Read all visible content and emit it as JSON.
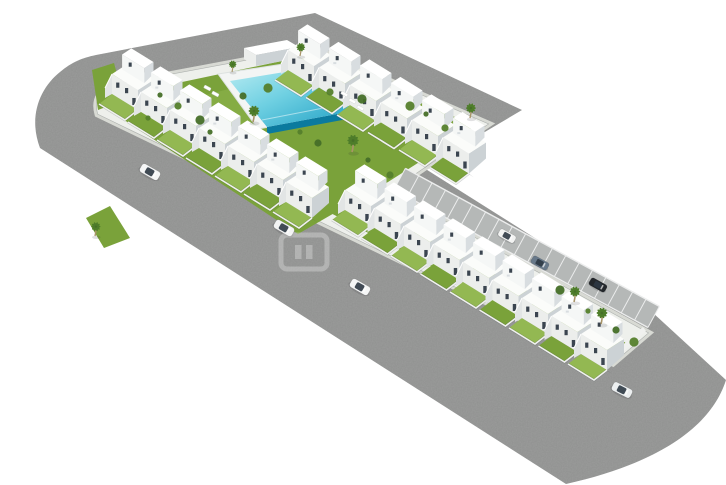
{
  "meta": {
    "description": "Aerial isometric 3D render of a white residential housing development with communal pool, perimeter roads, parking strip and cars",
    "visible_text": "none"
  },
  "scene": {
    "canvas": {
      "w": 726,
      "h": 485,
      "background": "#ffffff"
    },
    "colors": {
      "road": "#9c9d9c",
      "road_noise": "#5f605f",
      "sidewalk": "#d8dad4",
      "curb_line": "rgba(95,100,104,0.35)",
      "platform": "#eef0ec",
      "grass": "#7aa23a",
      "grass_light": "#93b852",
      "bush": "#55802c",
      "bush_dark": "#466f28",
      "palm_frond": "#4e7d2a",
      "palm_trunk": "#a89468",
      "pool_deck": "#f3f5f4",
      "pool_deck_edge": "#dde2e0",
      "pool_water_top": "#b9ecf2",
      "pool_water_mid": "#6fd0e2",
      "pool_water_deep": "#1f9fc4",
      "pool_rim": "#0b7a9e",
      "pool_rim_light": "#1490b4",
      "house_top": "#fbfcfa",
      "house_top2": "#ffffff",
      "house_front": "#eceeec",
      "house_front_upper": "#f5f7f6",
      "house_side": "#ccd2d5",
      "house_side_upper": "#d8dde0",
      "window": "#3b4550",
      "stair": "#e2e5e5",
      "wall_white": "#f0f1ef",
      "wall_dark": "rgba(70,75,80,0.28)",
      "parking_strip": "#b5b8b7",
      "parking_line": "#eceded",
      "shadow": "rgba(40,45,50,0.14)",
      "car_window": "#2e3944",
      "watermark": "#ffffff"
    },
    "roads": {
      "asphalt": "M 96,55 L 315,13 L 522,110 L 424,168 L 652,312 L 726,380 C 712,424 664,462 566,484 L 40,148 C 28,116 40,88 60,72 C 72,62 82,58 96,55 Z M 313,48 L 115,85 C 100,89 94,100 98,114 L 613,363 L 648,333 L 390,191 L 488,124 Z",
      "hole": "M 313,48 L 115,85 C 100,89 94,100 98,114 L 613,363 L 648,333 L 390,191 L 488,124 Z"
    },
    "greens": [
      {
        "name": "courtyard-lawn",
        "pts": "130,93 310,55 476,126 388,182 298,234 112,112"
      },
      {
        "name": "lawn-patch-left",
        "pts": "92,70 114,63 124,100 98,110"
      },
      {
        "name": "corner-lawn",
        "pts": "86,218 110,206 130,238 104,248"
      },
      {
        "name": "lower-garden-strip",
        "pts": "348,196 628,344 602,357 325,210"
      },
      {
        "name": "lawn-highlight",
        "pts": "185,100 265,80 300,122 215,138",
        "light": true,
        "op": 0.45
      }
    ],
    "pool": {
      "deck": "218,74 322,58 364,110 258,129",
      "water": "230,81 315,67 353,111 267,127",
      "rim": "353,111 267,127 267,134 353,118",
      "rim2": "315,67 353,111 353,118 315,74"
    },
    "structures": [
      {
        "name": "pool-house-roof",
        "pts": "244,48 287,40 299,47 256,55",
        "fill": "house_top2"
      },
      {
        "name": "pool-house-front",
        "pts": "244,48 256,55 256,66 244,59",
        "fill": "house_front"
      },
      {
        "name": "pool-house-side",
        "pts": "256,55 299,47 299,58 256,66",
        "fill": "house_side"
      },
      {
        "name": "end-wall",
        "pts": "646,331 612,362 609,357 643,327",
        "fill": "wall_white"
      }
    ],
    "parking": {
      "x1": 392,
      "y1": 193,
      "x2": 646,
      "y2": 331,
      "gap": 4,
      "width": 24,
      "ticks": 19
    },
    "house_rows": [
      {
        "name": "house-row-upper-left",
        "n": 7,
        "x": 112,
        "y": 74,
        "sx": 29,
        "sy": 18
      },
      {
        "name": "house-row-upper-right",
        "n": 6,
        "x": 288,
        "y": 50,
        "sx": 31,
        "sy": 17.5
      },
      {
        "name": "house-row-lower",
        "n": 9,
        "x": 345,
        "y": 190,
        "sx": 29.5,
        "sy": 18
      }
    ],
    "house_geometry": {
      "aw": 26,
      "ah": 16,
      "bw": 17,
      "bh": -11,
      "floor1": 20,
      "floor2": 15,
      "garden_x": -13,
      "garden_y": 10
    },
    "palms": [
      {
        "x": 253,
        "y": 122,
        "s": 1
      },
      {
        "x": 232,
        "y": 72,
        "s": 0.7
      },
      {
        "x": 300,
        "y": 56,
        "s": 0.8
      },
      {
        "x": 352,
        "y": 152,
        "s": 1.05
      },
      {
        "x": 470,
        "y": 118,
        "s": 0.9
      },
      {
        "x": 95,
        "y": 236,
        "s": 0.85
      },
      {
        "x": 574,
        "y": 302,
        "s": 0.95
      },
      {
        "x": 601,
        "y": 324,
        "s": 1
      }
    ],
    "bushes": [
      [
        160,
        95
      ],
      [
        178,
        106
      ],
      [
        200,
        120
      ],
      [
        148,
        118
      ],
      [
        243,
        96
      ],
      [
        268,
        88
      ],
      [
        210,
        132
      ],
      [
        330,
        92
      ],
      [
        362,
        99
      ],
      [
        300,
        132
      ],
      [
        318,
        143
      ],
      [
        410,
        106
      ],
      [
        426,
        114
      ],
      [
        445,
        128
      ],
      [
        560,
        290
      ],
      [
        588,
        311
      ],
      [
        616,
        330
      ],
      [
        634,
        342
      ],
      [
        368,
        160
      ],
      [
        390,
        175
      ]
    ],
    "loungers": [
      [
        342,
        91
      ],
      [
        350,
        98
      ],
      [
        358,
        105
      ],
      [
        205,
        85
      ],
      [
        213,
        91
      ]
    ],
    "cars_on_road": [
      {
        "x": 150,
        "y": 172,
        "angle": 30,
        "color": "#f5f6f6"
      },
      {
        "x": 284,
        "y": 228,
        "angle": 30,
        "color": "#f2f3f3"
      },
      {
        "x": 360,
        "y": 287,
        "angle": 30,
        "color": "#f5f6f6"
      },
      {
        "x": 622,
        "y": 390,
        "angle": 27,
        "color": "#eceff0"
      }
    ],
    "cars_parked": [
      {
        "x": 507,
        "y": 236,
        "angle": 29,
        "color": "#f2f3f2"
      },
      {
        "x": 540,
        "y": 263,
        "angle": 29,
        "color": "#68798a"
      },
      {
        "x": 598,
        "y": 285,
        "angle": 29,
        "color": "#23272b"
      }
    ],
    "watermark": {
      "x": 281,
      "y": 235,
      "w": 46,
      "h": 34,
      "opacity": 0.28
    }
  }
}
